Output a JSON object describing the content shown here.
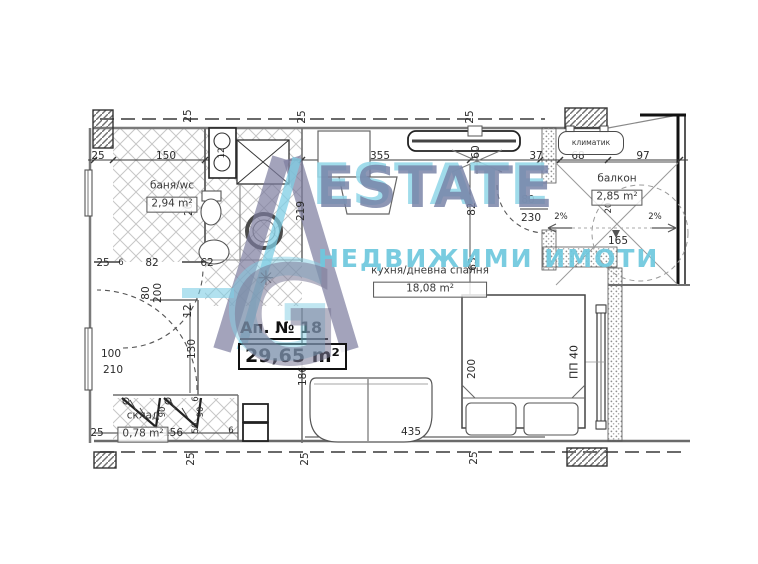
{
  "watermark": {
    "brand": "ESTATE",
    "subtitle": "НЕДВИЖИМИ ИМОТИ",
    "monogram": "G",
    "colors": {
      "slate": "#7580a5",
      "cyan": "#7ecfe0"
    }
  },
  "apartment": {
    "number_label": "Ап. № 18",
    "total_area": "29,65 m²"
  },
  "labels": {
    "air_conditioner": "климатик",
    "window_mark": "ПП 40"
  },
  "rooms": [
    {
      "id": "bathroom",
      "name": "баня/wc",
      "area": "2,94 m²",
      "x": 172,
      "y": 196
    },
    {
      "id": "kitchen-living",
      "name": "кухня/дневна спалня",
      "area": "18,08 m²",
      "x": 430,
      "y": 281,
      "area_w": 104
    },
    {
      "id": "balcony",
      "name": "балкон",
      "area": "2,85 m²",
      "x": 617,
      "y": 189
    },
    {
      "id": "storage",
      "name": "склад",
      "area": "0,78 m²",
      "x": 143,
      "y": 426
    }
  ],
  "decorations": [
    {
      "name": "light-fixture-icon",
      "glyph": "✳",
      "x": 266,
      "y": 278,
      "size": 20,
      "color": "#4a4a4a"
    }
  ],
  "dimensions": [
    {
      "text": "25",
      "x": 98,
      "y": 156
    },
    {
      "text": "150",
      "x": 166,
      "y": 156
    },
    {
      "text": "12",
      "x": 222,
      "y": 153,
      "rot": "v",
      "small": true
    },
    {
      "text": "25",
      "x": 188,
      "y": 116,
      "rot": "v"
    },
    {
      "text": "25",
      "x": 302,
      "y": 117,
      "rot": "v"
    },
    {
      "text": "355",
      "x": 380,
      "y": 156
    },
    {
      "text": "25",
      "x": 470,
      "y": 117,
      "rot": "v"
    },
    {
      "text": "60",
      "x": 476,
      "y": 152,
      "rot": "v"
    },
    {
      "text": "37",
      "x": 536,
      "y": 156
    },
    {
      "text": "68",
      "x": 578,
      "y": 156
    },
    {
      "text": "97",
      "x": 643,
      "y": 156
    },
    {
      "text": "207",
      "x": 189,
      "y": 206,
      "rot": "v"
    },
    {
      "text": "219",
      "x": 301,
      "y": 211,
      "rot": "v"
    },
    {
      "text": "82",
      "x": 472,
      "y": 209,
      "rot": "v"
    },
    {
      "text": "63",
      "x": 473,
      "y": 264,
      "rot": "v"
    },
    {
      "text": "80",
      "x": 528,
      "y": 200
    },
    {
      "text": "230",
      "x": 531,
      "y": 218
    },
    {
      "text": "20",
      "x": 609,
      "y": 208,
      "rot": "v",
      "small": true
    },
    {
      "text": "165",
      "x": 618,
      "y": 241
    },
    {
      "text": "2%",
      "x": 561,
      "y": 217,
      "small": true
    },
    {
      "text": "2%",
      "x": 655,
      "y": 217,
      "small": true
    },
    {
      "text": "25",
      "x": 103,
      "y": 263
    },
    {
      "text": "6",
      "x": 121,
      "y": 263,
      "small": true
    },
    {
      "text": "82",
      "x": 152,
      "y": 263
    },
    {
      "text": "62",
      "x": 207,
      "y": 263
    },
    {
      "text": "80",
      "x": 146,
      "y": 293,
      "rot": "v"
    },
    {
      "text": "200",
      "x": 158,
      "y": 293,
      "rot": "v"
    },
    {
      "text": "12",
      "x": 188,
      "y": 311,
      "rot": "v"
    },
    {
      "text": "130",
      "x": 192,
      "y": 349,
      "rot": "v"
    },
    {
      "text": "100",
      "x": 111,
      "y": 354
    },
    {
      "text": "210",
      "x": 113,
      "y": 370
    },
    {
      "text": "186",
      "x": 303,
      "y": 376,
      "rot": "v"
    },
    {
      "text": "200",
      "x": 472,
      "y": 369,
      "rot": "v"
    },
    {
      "text": "90",
      "x": 163,
      "y": 412,
      "rot": "v",
      "small": true
    },
    {
      "text": "90",
      "x": 201,
      "y": 412,
      "rot": "v",
      "small": true
    },
    {
      "text": "6",
      "x": 196,
      "y": 399,
      "rot": "v",
      "small": true
    },
    {
      "text": "50",
      "x": 196,
      "y": 428,
      "rot": "v",
      "small": true
    },
    {
      "text": "25",
      "x": 97,
      "y": 433
    },
    {
      "text": "156",
      "x": 173,
      "y": 433
    },
    {
      "text": "6",
      "x": 231,
      "y": 431,
      "small": true
    },
    {
      "text": "435",
      "x": 411,
      "y": 432
    },
    {
      "text": "25",
      "x": 191,
      "y": 459,
      "rot": "v"
    },
    {
      "text": "25",
      "x": 305,
      "y": 459,
      "rot": "v"
    },
    {
      "text": "25",
      "x": 474,
      "y": 458,
      "rot": "v"
    }
  ]
}
